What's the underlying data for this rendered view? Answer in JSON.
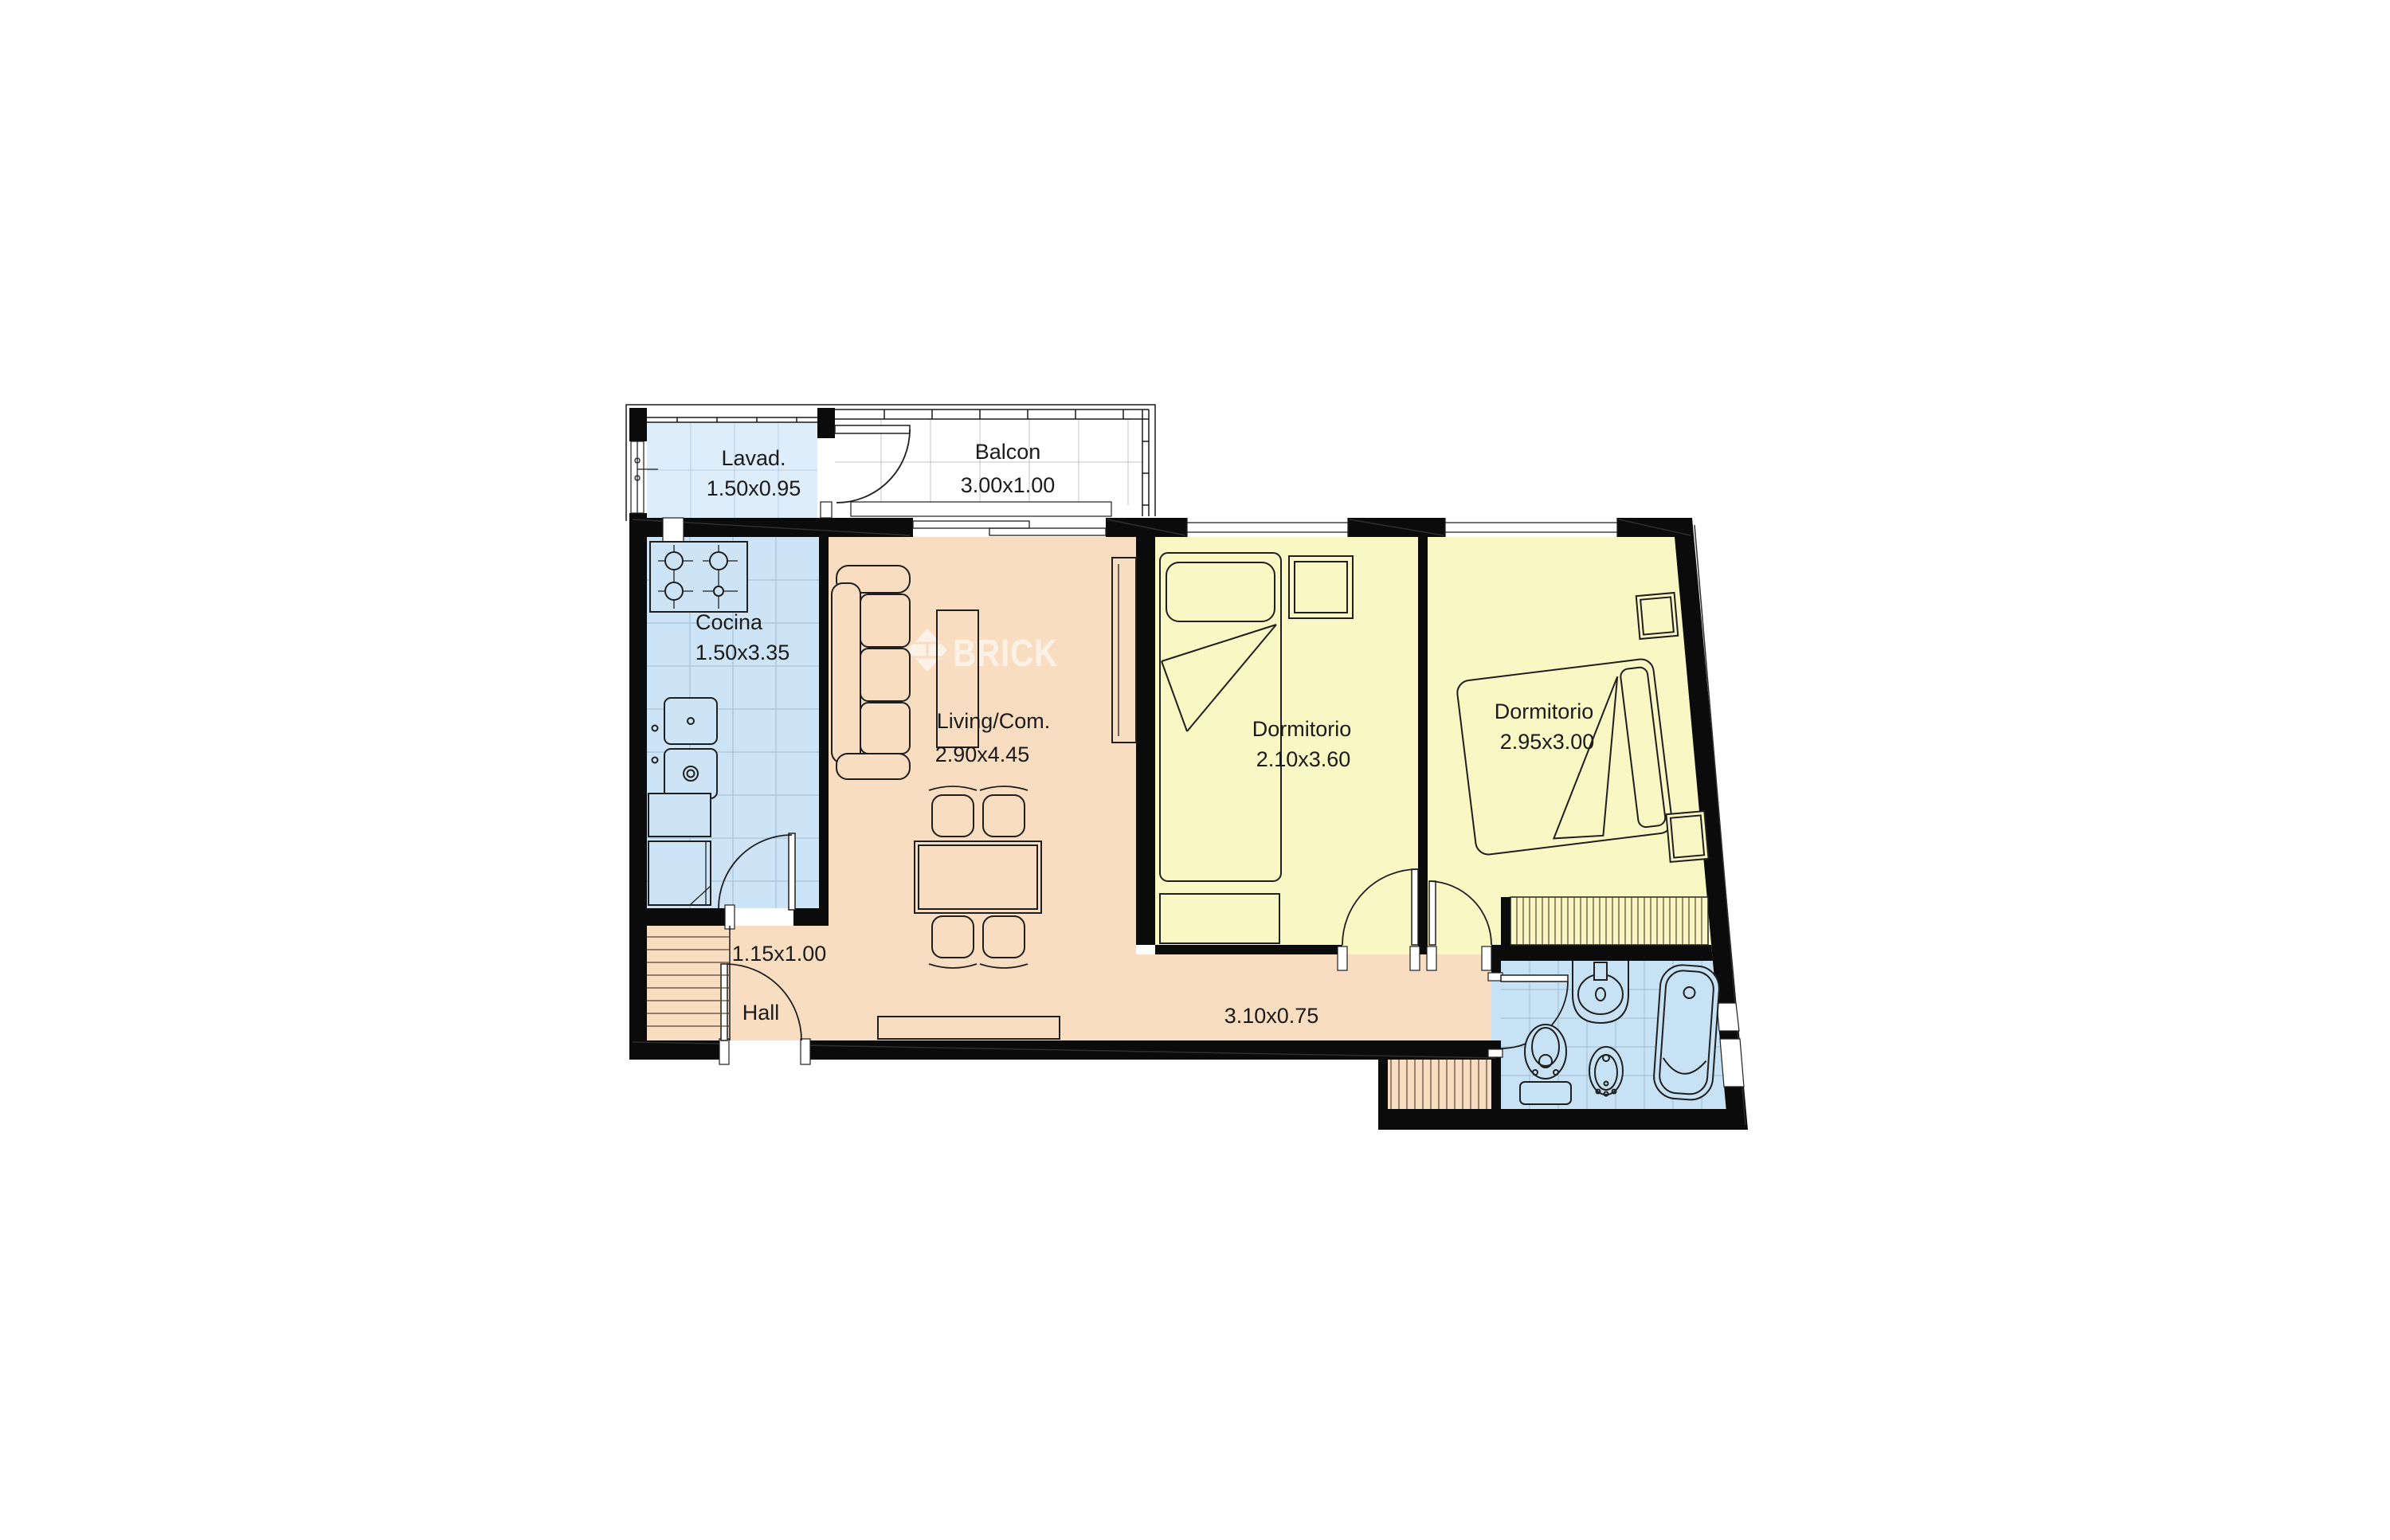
{
  "meta": {
    "type": "floor-plan",
    "language": "es"
  },
  "watermark": {
    "brand": "BRICK"
  },
  "palette": {
    "wall": "#0b0b0b",
    "floor_living": "#f8ddc1",
    "floor_bedroom": "#f9f7c3",
    "floor_kitchen": "#cde4f6",
    "floor_laundry": "#ddedf9",
    "floor_bathroom": "#c8e2f5",
    "floor_balcony": "#ffffff",
    "tile_line": "#9fbdd4",
    "text": "#1b1b1b",
    "watermark_color": "rgba(255,255,255,0.6)"
  },
  "rooms": {
    "lavadero": {
      "name": "Lavad.",
      "dims": "1.50x0.95"
    },
    "balcon": {
      "name": "Balcon",
      "dims": "3.00x1.00"
    },
    "cocina": {
      "name": "Cocina",
      "dims": "1.50x3.35"
    },
    "living": {
      "name": "Living/Com.",
      "dims": "2.90x4.45"
    },
    "dormitorio1": {
      "name": "Dormitorio",
      "dims": "2.10x3.60"
    },
    "dormitorio2": {
      "name": "Dormitorio",
      "dims": "2.95x3.00"
    },
    "hall": {
      "name": "Hall",
      "dims": "1.15x1.00"
    },
    "pasillo": {
      "dims": "3.10x0.75"
    }
  }
}
